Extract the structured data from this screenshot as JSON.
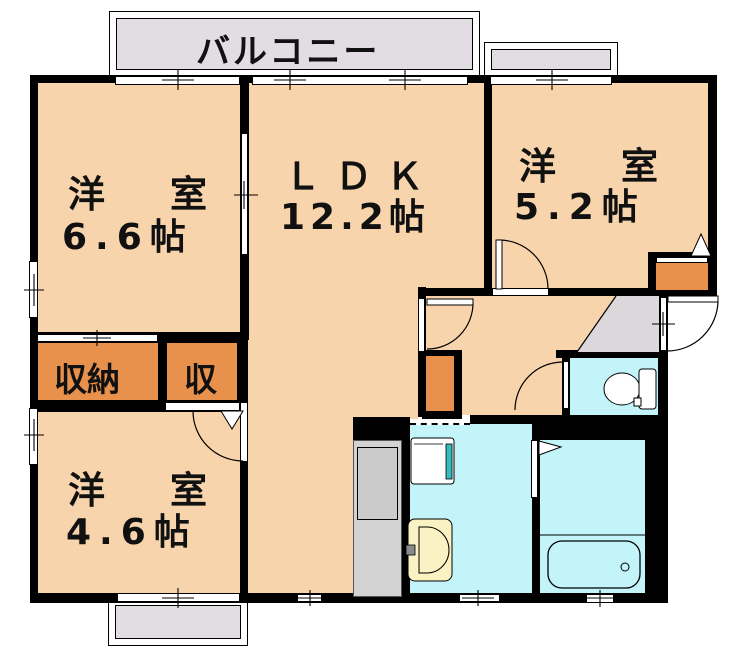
{
  "plan_title": "2LDK apartment floor plan",
  "balcony": {
    "label": "バルコニー"
  },
  "rooms": {
    "room_66": {
      "name": "洋　室",
      "size": "6.6帖"
    },
    "ldk": {
      "name": "ＬＤＫ",
      "size": "12.2帖"
    },
    "room_52": {
      "name": "洋　室",
      "size": "5.2帖"
    },
    "room_46": {
      "name": "洋　室",
      "size": "4.6帖"
    },
    "closet_main": {
      "label": "収納"
    },
    "closet_small": {
      "label": "収"
    }
  },
  "colors": {
    "room": "#F8D4AC",
    "wet": "#C2F4F9",
    "closet": "#E8914C",
    "balcony": "#E1DDE3",
    "genkan": "#DCD7DB",
    "counter": "#D2D2D2",
    "counter_inner": "#CBCBCB",
    "cream": "#FAF2C2",
    "teal": "#35BCBC",
    "wall": "#000000"
  }
}
